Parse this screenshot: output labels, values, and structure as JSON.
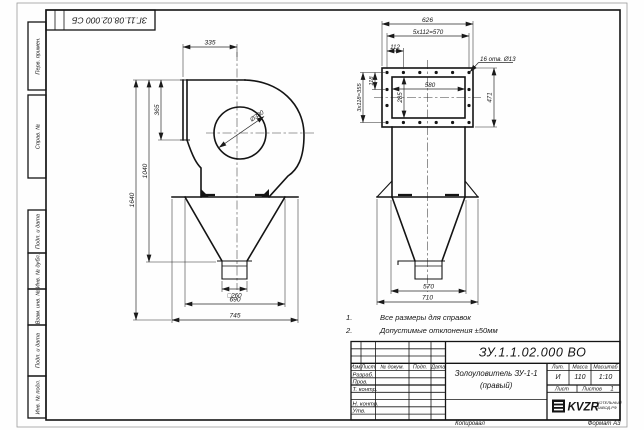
{
  "frame": {
    "top_stamp": "ЗГ.11.08.02.000 СБ",
    "margins": {
      "perv": "Перв. примен.",
      "sprav": "Справ. №",
      "podp1": "Подп. и дата",
      "inv_dubl": "Инв. № дубл.",
      "vzam": "Взам. инв. №",
      "podp2": "Подп. и дата",
      "inv_podl": "Инв. № подл."
    },
    "footer": {
      "copied": "Копировал",
      "format": "Формат А3"
    }
  },
  "notes": {
    "n1_num": "1.",
    "n1_text": "Все размеры для справок",
    "n2_num": "2.",
    "n2_text": "Допустимые отклонения ±50мм"
  },
  "side_view": {
    "dim_inlet_width": "335",
    "dim_flange_height": "365",
    "dim_height_mid": "1040",
    "dim_height_total": "1640",
    "dim_scroll_diameter": "Ø380",
    "dim_outlet": "□260",
    "dim_cone_top": "690",
    "dim_overall_width": "745"
  },
  "front_view": {
    "dim_flange_width": "626",
    "dim_hole_pitch_h": "5x112=570",
    "dim_hole_offset": "112",
    "holes_note": "16 отв. Ø13",
    "dim_hole_pitch_v": "3x118=355",
    "dim_hole_offset_v": "118",
    "dim_opening_width": "580",
    "dim_opening_height": "285",
    "dim_flange_height": "471",
    "dim_cone_top": "570",
    "dim_overall_width": "710"
  },
  "title_block": {
    "doc_number": "ЗУ.1.1.02.000 ВО",
    "product_name_line1": "Золоуловитель ЗУ-1-1",
    "product_name_line2": "(правый)",
    "cols": {
      "izm": "Изм.",
      "list": "Лист",
      "doc": "№ докум.",
      "podp": "Подп.",
      "data": "Дата"
    },
    "rows": {
      "razrab": "Разраб.",
      "prov": "Пров.",
      "t_contr": "Т. контр.",
      "n_contr": "Н. контр.",
      "utv": "Утв."
    },
    "lit_label": "Лит.",
    "lit_value": "И",
    "mass_label": "Масса",
    "mass_value": "110",
    "scale_label": "Масштаб",
    "scale_value": "1:10",
    "sheet_label": "Лист",
    "sheets_label": "Листов",
    "sheets_value": "1",
    "logo_text": "KVZR",
    "logo_caption_line1": "КОТЕЛЬНЫЙ",
    "logo_caption_line2": "ЗАВОД.РФ"
  }
}
